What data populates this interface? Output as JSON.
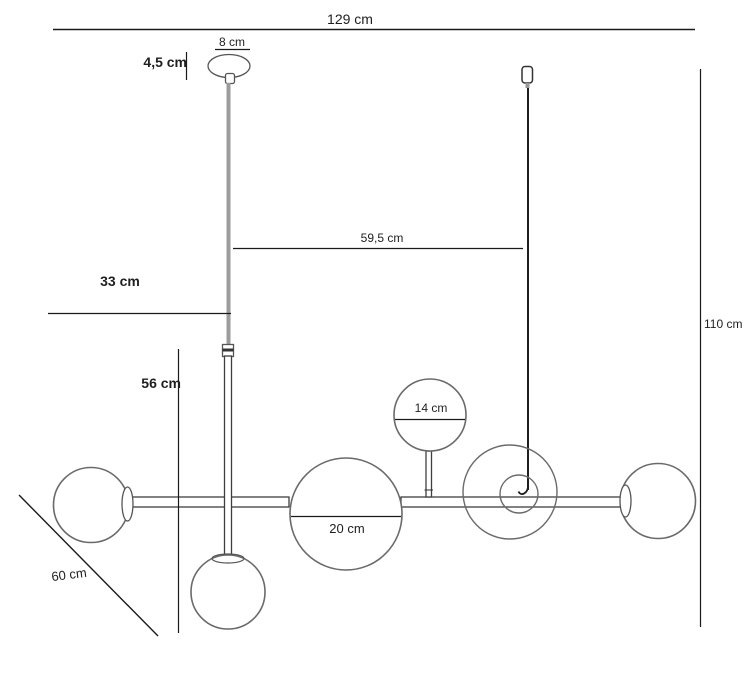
{
  "diagram": {
    "labels": {
      "total_width": "129 cm",
      "canopy_diameter": "8 cm",
      "canopy_height": "4,5 cm",
      "stem_height": "33 cm",
      "cord_spacing": "59,5 cm",
      "right_drop": "110 cm",
      "center_drop": "56 cm",
      "small_globe": "14 cm",
      "large_globe": "20 cm",
      "depth": "60 cm"
    },
    "colors": {
      "background": "#ffffff",
      "dimension_line": "#1a1a1a",
      "glass_outline": "#6a6a6a",
      "metal_outline": "#3f3f3f",
      "cord_gray": "#9c9c9c",
      "cord_black": "#1f1f1f"
    }
  }
}
